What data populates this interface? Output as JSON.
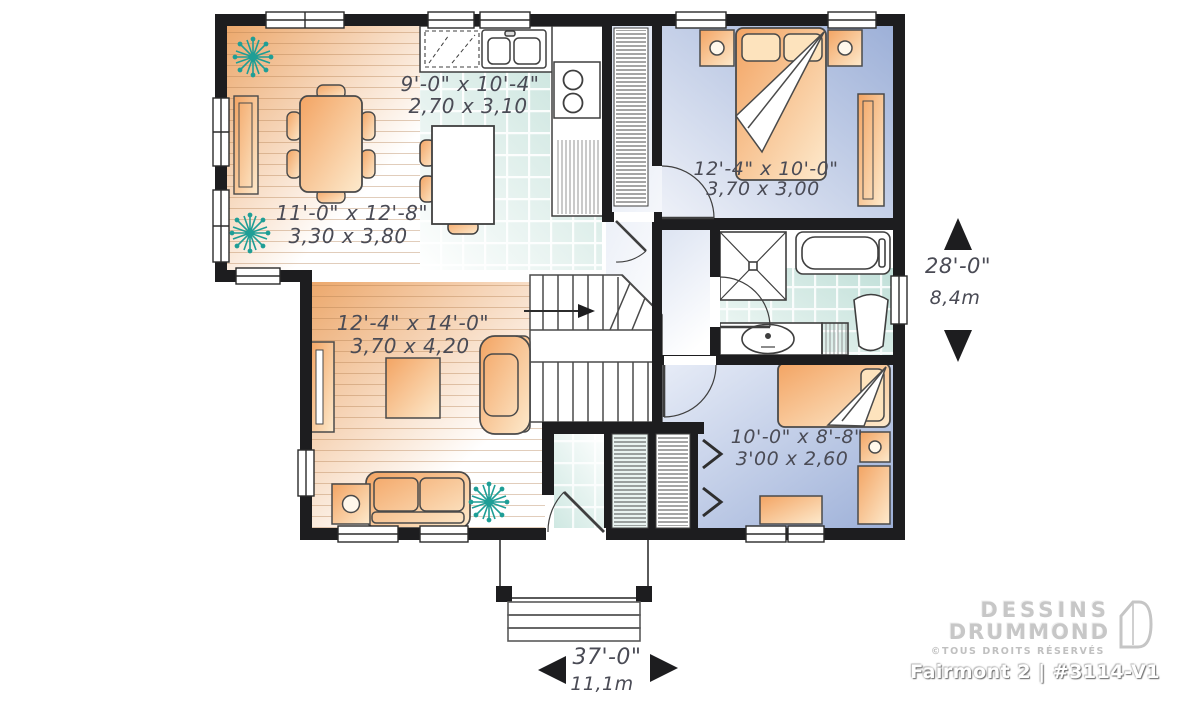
{
  "branding": {
    "brand_line1": "DESSINS",
    "brand_line2": "DRUMMOND",
    "rights_notice": "©TOUS DROITS RÉSERVÉS",
    "plan_title": "Fairmont 2 | #3114-V1"
  },
  "rooms": {
    "kitchen": {
      "imperial": "9'-0\" x 10'-4\"",
      "metric": "2,70 x 3,10"
    },
    "dining": {
      "imperial": "11'-0\" x 12'-8\"",
      "metric": "3,30 x 3,80"
    },
    "bedroom1": {
      "imperial": "12'-4\" x 10'-0\"",
      "metric": "3,70 x 3,00"
    },
    "living": {
      "imperial": "12'-4\" x 14'-0\"",
      "metric": "3,70 x 4,20"
    },
    "bedroom2": {
      "imperial": "10'-0\" x 8'-8\"",
      "metric": "3'00 x 2,60"
    }
  },
  "overall_dimensions": {
    "depth": {
      "imperial": "28'-0\"",
      "metric": "8,4m"
    },
    "width": {
      "imperial": "37'-0\"",
      "metric": "11,1m"
    }
  },
  "colors": {
    "wall": "#1d1d1f",
    "furniture_accent": "#f5b97e",
    "bedroom_floor": "#a8b7db",
    "tile_floor": "#cde6e0",
    "plant": "#1f9e96",
    "label_text": "#4a4b55"
  }
}
